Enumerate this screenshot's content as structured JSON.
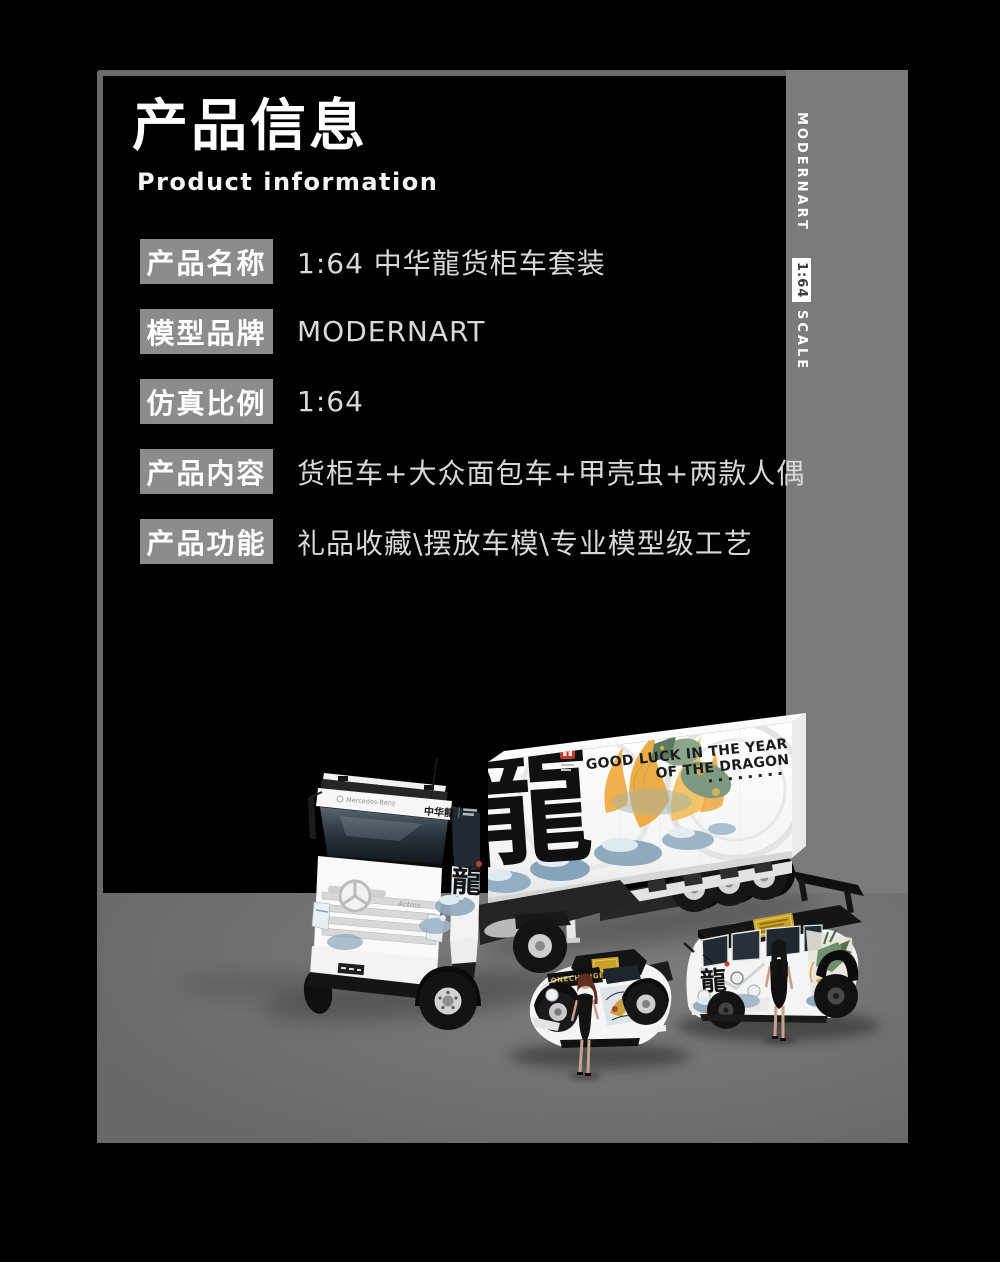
{
  "header": {
    "title": "产品信息",
    "subtitle": "Product information"
  },
  "sidebar": {
    "brand": "MODERNART",
    "scale": "1:64",
    "scale_word": "SCALE"
  },
  "specs": [
    {
      "label": "产品名称",
      "value": "1:64 中华龍货柜车套装"
    },
    {
      "label": "模型品牌",
      "value": "MODERNART"
    },
    {
      "label": "仿真比例",
      "value": "1:64"
    },
    {
      "label": "产品内容",
      "value": "货柜车+大众面包车+甲壳虫+两款人偶"
    },
    {
      "label": "产品功能",
      "value": "礼品收藏\\摆放车模\\专业模型级工艺"
    }
  ],
  "photo": {
    "slogan_line1": "GOOD LUCK IN THE YEAR",
    "slogan_line2": "OF THE DRAGON",
    "container_char": "龍",
    "cab_side_brand": "中华龍",
    "cab_brand": "Mercedes-Benz",
    "cab_model": "Actros",
    "cab_art_char": "龍",
    "beetle_banner": "ONECHANGE",
    "bus_char": "龍"
  },
  "colors": {
    "background": "#000000",
    "panel_border": "#6a6a6a",
    "side_strip": "#7b7b7b",
    "floor": "#727272",
    "label_box": "#8c8c8c",
    "value_text": "#d8d8d8",
    "seal_red": "#bf3a30",
    "gold": "#c9a227"
  }
}
